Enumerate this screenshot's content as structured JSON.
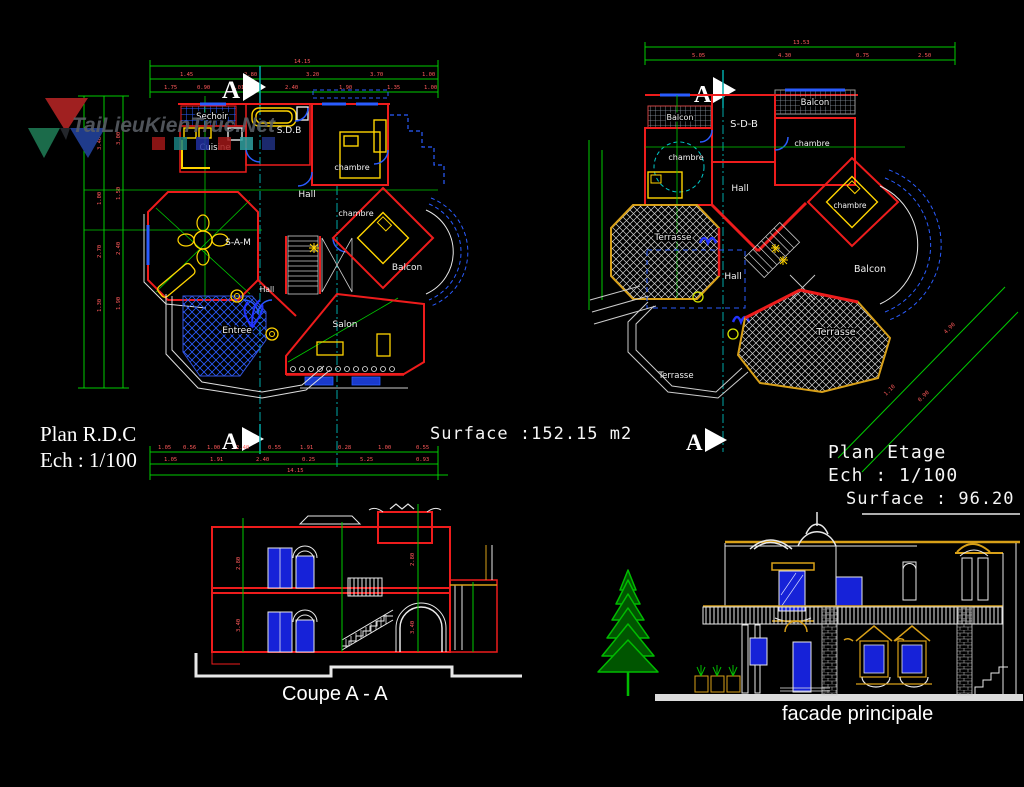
{
  "watermark": {
    "site": "TaiLieuKienTruc.Net",
    "squares": [
      "#a01818",
      "#1a8080",
      "#2030a0",
      "#a01818",
      "#30a0a0",
      "#203080"
    ]
  },
  "plan_rdc": {
    "title": "Plan R.D.C",
    "scale": "Ech : 1/100",
    "surface": "Surface :152.15 m2",
    "marker": "A",
    "rooms": {
      "sechoir": "Sechoir",
      "sdb": "S.D.B",
      "cuisine": "Cuisine",
      "chambre_top": "chambre",
      "hall_upper": "Hall",
      "chambre_mid": "chambre",
      "sam": "S-A-M",
      "balcon": "Balcon",
      "hall_lower": "Hall",
      "entree": "Entree",
      "salon": "Salon"
    },
    "dims": {
      "top_total": "14.15",
      "top_mid": [
        "1.45",
        "2.80",
        "3.20",
        "3.70",
        "1.00"
      ],
      "top_low": [
        "1.75",
        "0.90",
        "1.01",
        "2.40",
        "1.90",
        "1.35",
        "1.00"
      ],
      "bottom_total": "14.15",
      "bottom_rows": [
        "1.05",
        "0.56",
        "1.00",
        "2.40",
        "0.55",
        "1.91",
        "0.28",
        "1.00",
        "0.55"
      ],
      "bottom_mid": [
        "1.05",
        "1.91",
        "2.40",
        "0.25",
        "5.25",
        "0.93"
      ],
      "left": [
        "3.40",
        "1.00",
        "2.70",
        "1.30",
        "3.00",
        "1.50",
        "2.40",
        "1.90"
      ]
    }
  },
  "plan_etage": {
    "title": "Plan Etage",
    "scale": "Ech :  1/100",
    "surface": "Surface : 96.20 m2",
    "marker": "A",
    "rooms": {
      "balcon_tl": "Balcon",
      "sdb": "S-D-B",
      "balcon_tr": "Balcon",
      "chambre_left": "chambre",
      "chambre_right": "chambre",
      "chambre_far": "chambre",
      "hall_upper": "Hall",
      "terrasse_left": "Terrasse",
      "hall_center": "Hall",
      "balcon_right": "Balcon",
      "terrasse_main": "Terrasse",
      "terrasse_lower": "Terrasse"
    },
    "dims": {
      "top_total": "13.53",
      "top_row": [
        "5.05",
        "4.30",
        "0.75",
        "2.50"
      ],
      "diag": [
        "4.90",
        "1.10",
        "0.90"
      ]
    }
  },
  "coupe": {
    "title": "Coupe  A - A",
    "dims": [
      "2.80",
      "3.40",
      "2.80",
      "3.40"
    ]
  },
  "facade": {
    "title": "facade principale"
  }
}
